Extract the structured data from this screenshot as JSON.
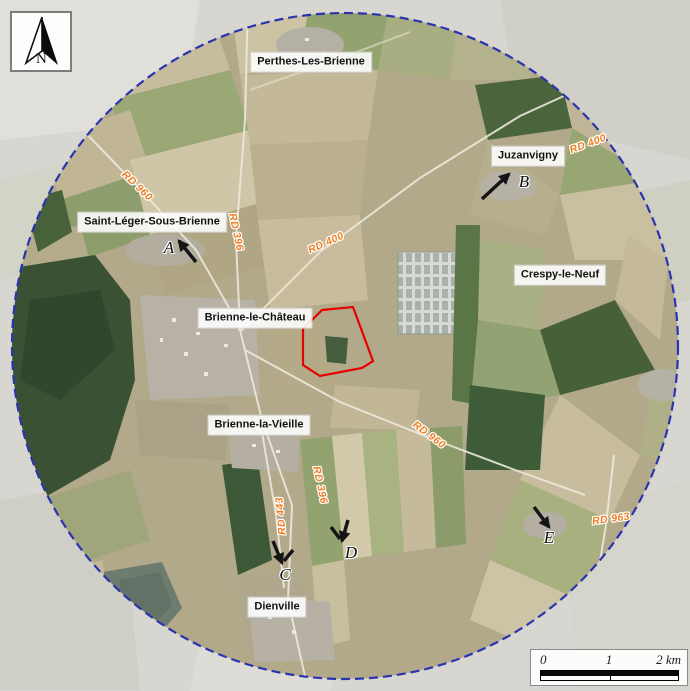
{
  "map": {
    "north_label": "N",
    "towns": [
      {
        "name": "Perthes-Les-Brienne",
        "x": 311,
        "y": 62
      },
      {
        "name": "Juzanvigny",
        "x": 528,
        "y": 156
      },
      {
        "name": "Saint-Léger-Sous-Brienne",
        "x": 152,
        "y": 222
      },
      {
        "name": "Crespy-le-Neuf",
        "x": 560,
        "y": 275
      },
      {
        "name": "Brienne-le-Château",
        "x": 255,
        "y": 318
      },
      {
        "name": "Brienne-la-Vieille",
        "x": 259,
        "y": 425
      },
      {
        "name": "Dienville",
        "x": 277,
        "y": 607
      }
    ],
    "roads": [
      {
        "name": "RD 400",
        "x": 588,
        "y": 144,
        "angle": -20
      },
      {
        "name": "RD 960",
        "x": 137,
        "y": 186,
        "angle": 44
      },
      {
        "name": "RD 396",
        "x": 236,
        "y": 232,
        "angle": 78
      },
      {
        "name": "RD 400",
        "x": 326,
        "y": 243,
        "angle": -24
      },
      {
        "name": "RD 960",
        "x": 429,
        "y": 435,
        "angle": 37
      },
      {
        "name": "RD 396",
        "x": 320,
        "y": 485,
        "angle": 78
      },
      {
        "name": "RD 443",
        "x": 281,
        "y": 516,
        "angle": -95
      },
      {
        "name": "RD 963",
        "x": 611,
        "y": 519,
        "angle": -8
      }
    ],
    "markers": [
      {
        "letter": "A",
        "x": 169,
        "y": 248
      },
      {
        "letter": "B",
        "x": 524,
        "y": 182
      },
      {
        "letter": "C",
        "x": 285,
        "y": 575
      },
      {
        "letter": "D",
        "x": 351,
        "y": 553
      },
      {
        "letter": "E",
        "x": 549,
        "y": 538
      }
    ],
    "scalebar": {
      "t0": "0",
      "t1": "1",
      "t2": "2 km"
    },
    "colors": {
      "study_circle": "#2a34ad",
      "site_outline": "#e60000",
      "road_label": "#ef7e22"
    }
  }
}
